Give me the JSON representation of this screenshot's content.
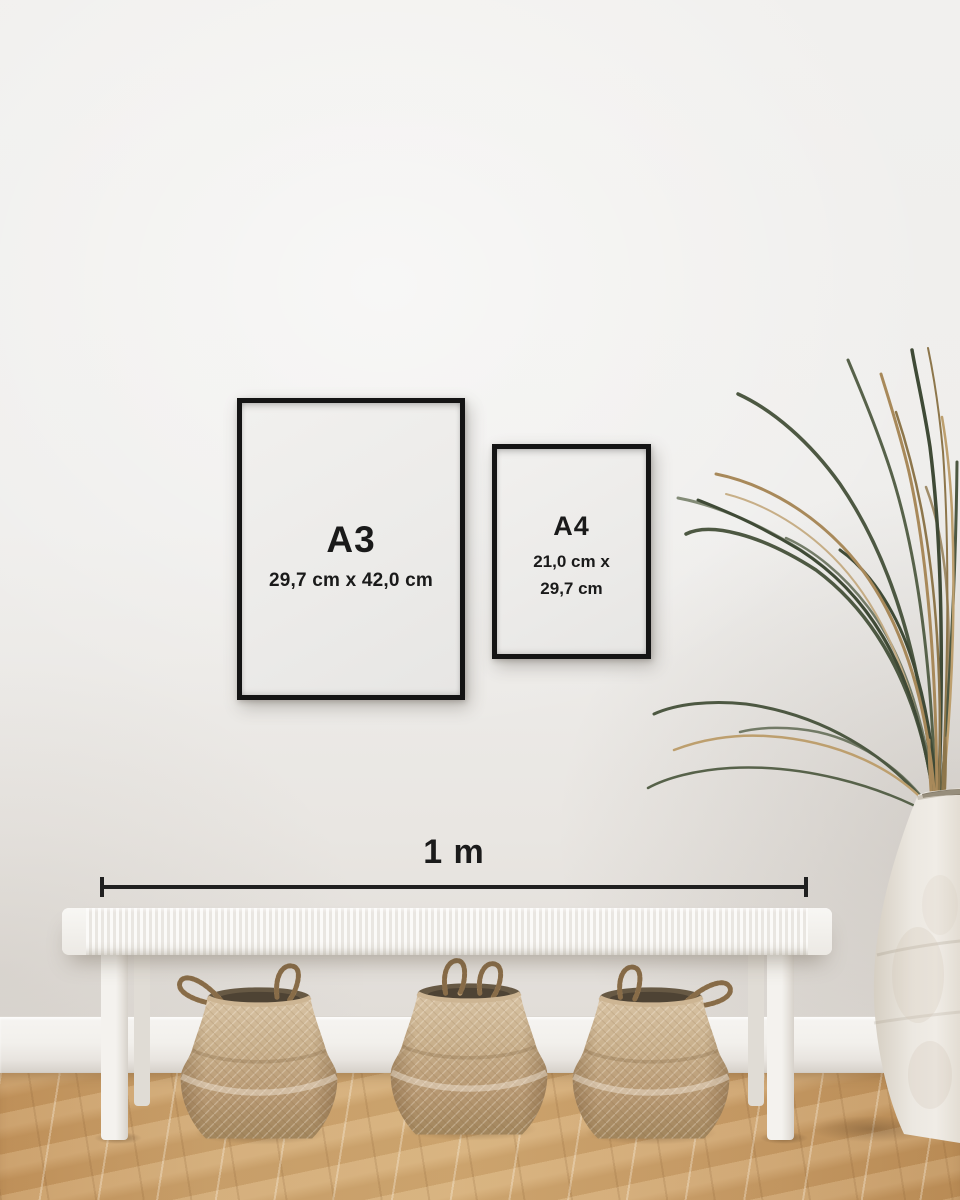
{
  "frames": {
    "a3": {
      "label": "A3",
      "dimensions": "29,7 cm x 42,0 cm"
    },
    "a4": {
      "label": "A4",
      "dimensions": "21,0 cm x\n29,7 cm"
    }
  },
  "ruler": {
    "label": "1 m"
  },
  "colors": {
    "frame_black": "#141414",
    "label_text": "#1a1a1a",
    "wall": "#efeeec",
    "baseboard": "#f2f0ec",
    "floor_wood": "#cba06a",
    "bench_white": "#f4f2ee",
    "basket_tan": "#c0a47f",
    "basket_interior": "#675944",
    "vase_cream": "#ece8e1",
    "palm_green": "#4d5842",
    "palm_dried": "#a8895a"
  }
}
